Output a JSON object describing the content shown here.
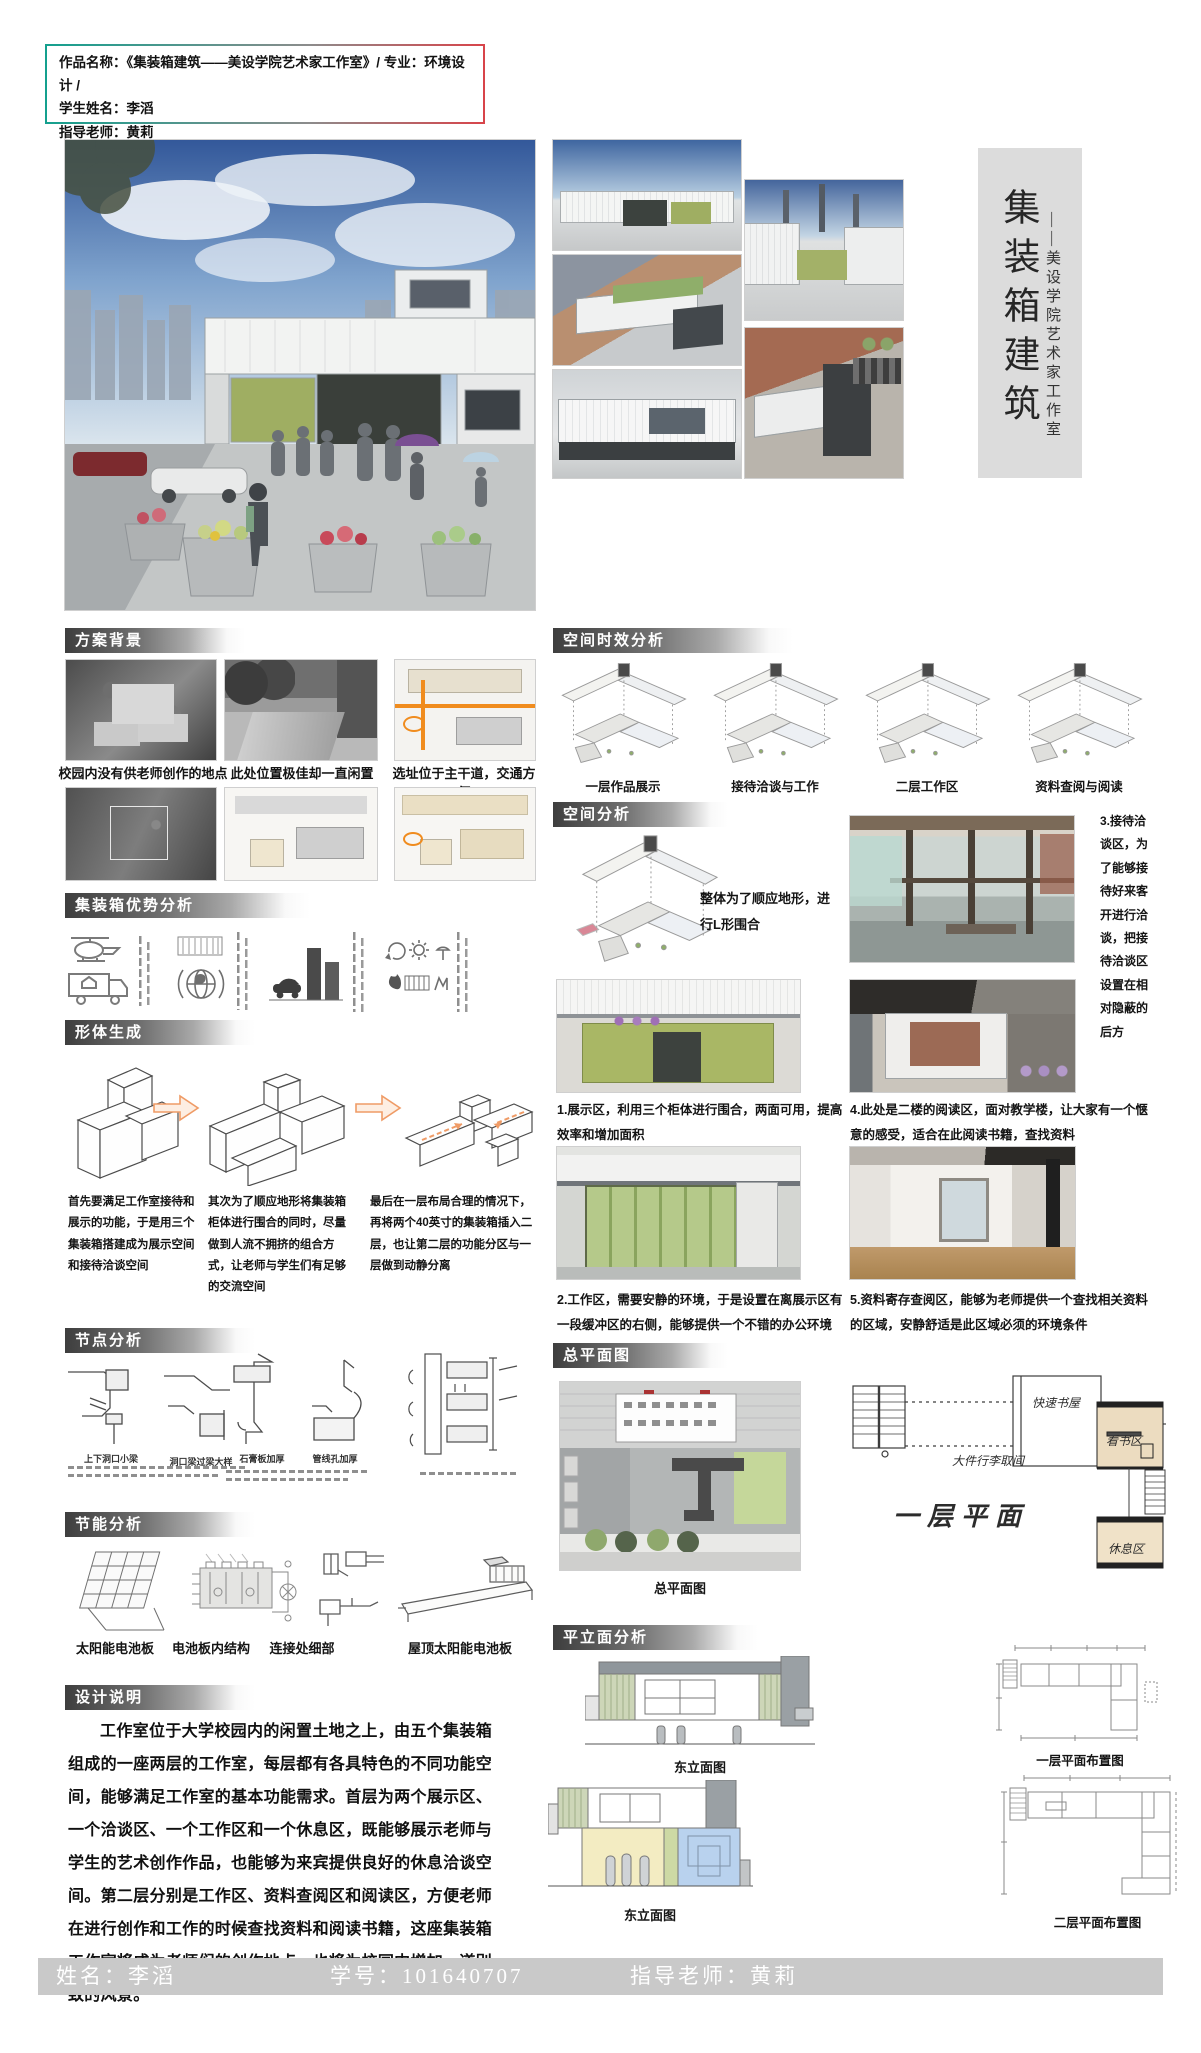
{
  "header_box": {
    "line1": "作品名称：《集装箱建筑——美设学院艺术家工作室》/ 专业：环境设计 /",
    "line2": "学生姓名：李滔",
    "line3": "指导老师：黄莉"
  },
  "title_block": {
    "main": "集装箱建筑",
    "sub": "——美设学院艺术家工作室"
  },
  "sections": {
    "background": {
      "title": "方案背景",
      "captions": [
        "校园内没有供老师创作的地点",
        "此处位置极佳却一直闲置",
        "选址位于主干道，交通方便"
      ]
    },
    "advantage": {
      "title": "集装箱优势分析"
    },
    "form_generation": {
      "title": "形体生成",
      "paragraphs": [
        "首先要满足工作室接待和展示的功能，于是用三个集装箱搭建成为展示空间和接待洽谈空间",
        "其次为了顺应地形将集装箱柜体进行围合的同时，尽量做到人流不拥挤的组合方式，让老师与学生们有足够的交流空间",
        "最后在一层布局合理的情况下，再将两个40英寸的集装箱插入二层，也让第二层的功能分区与一层做到动静分离"
      ]
    },
    "node_analysis": {
      "title": "节点分析",
      "captions": [
        "上下洞口小梁",
        "洞口梁过梁大样",
        "石膏板加厚",
        "管线孔加厚"
      ]
    },
    "energy": {
      "title": "节能分析",
      "captions": [
        "太阳能电池板",
        "电池板内结构",
        "连接处细部",
        "屋顶太阳能电池板"
      ]
    },
    "description": {
      "title": "设计说明",
      "text": "工作室位于大学校园内的闲置土地之上，由五个集装箱组成的一座两层的工作室，每层都有各具特色的不同功能空间，能够满足工作室的基本功能需求。首层为两个展示区、一个洽谈区、一个工作区和一个休息区，既能够展示老师与学生的艺术创作作品，也能够为来宾提供良好的休息洽谈空间。第二层分别是工作区、资料查阅区和阅读区，方便老师在进行创作和工作的时候查找资料和阅读书籍，这座集装箱工作室将成为老师们的创作地点，也将为校园内增加一道别致的风景。"
    },
    "time_analysis": {
      "title": "空间时效分析",
      "captions": [
        "一层作品展示",
        "接待洽谈与工作",
        "二层工作区",
        "资料查阅与阅读"
      ]
    },
    "space_analysis": {
      "title": "空间分析",
      "note": "整体为了顺应地形，进行L形围合",
      "caption1": "1.展示区，利用三个柜体进行围合，两面可用，提高效率和增加面积",
      "caption2": "2.工作区，需要安静的环境，于是设置在离展示区有一段缓冲区的右侧，能够提供一个不错的办公环境",
      "caption3": "3.接待洽谈区，为了能够接待好来客开进行洽谈，把接待洽谈区设置在相对隐蔽的后方",
      "caption4": "4.此处是二楼的阅读区，面对教学楼，让大家有一个惬意的感受，适合在此阅读书籍，查找资料",
      "caption5": "5.资料寄存查阅区，能够为老师提供一个查找相关资料的区域，安静舒适是此区域必须的环境条件"
    },
    "master_plan": {
      "title": "总平面图",
      "caption": "总平面图",
      "sketch_title": "一层平面",
      "labels": {
        "label1": "快速书屋",
        "label2": "大件行李取间",
        "label3": "看书区",
        "label4": "休息区"
      }
    },
    "plan_elevation": {
      "title": "平立面分析",
      "elevation1_caption": "东立面图",
      "elevation2_caption": "东立面图",
      "plan1_caption": "一层平面布置图",
      "plan2_caption": "二层平面布置图"
    }
  },
  "footer": {
    "name": "姓名：李滔",
    "student_id": "学号：101640707",
    "teacher": "指导老师：黄莉"
  },
  "colors": {
    "accent_teal": "#14a08e",
    "accent_red": "#d8444a",
    "arrow_orange": "#ef9b66",
    "road_orange": "#f08c1e",
    "footer_bg": "#c9c9c9",
    "title_strip_bg": "#dcdcdc"
  }
}
